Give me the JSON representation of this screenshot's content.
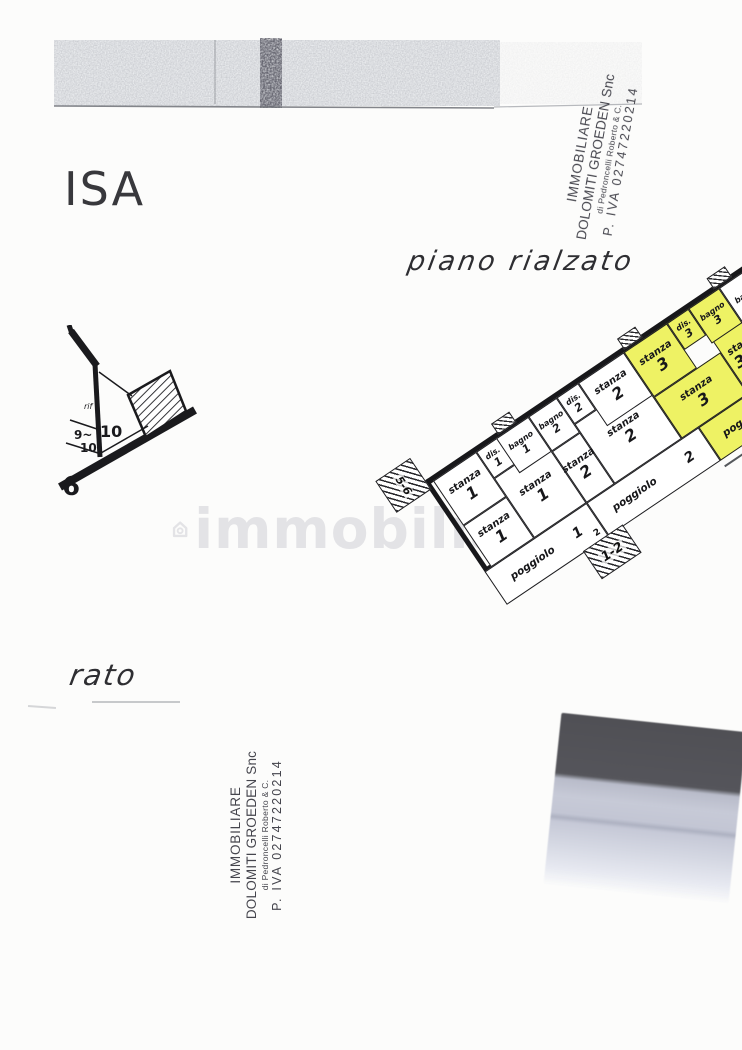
{
  "handwriting": {
    "isa": "ISA",
    "piano_rialzato": "piano rialzato",
    "rato": "rato"
  },
  "stamp": {
    "line1": "IMMOBILIARE",
    "line2": "DOLOMITI GROEDEN Snc",
    "line3": "di Pedroncelli Roberto & C.",
    "line4": "P. IVA 02747220214"
  },
  "watermark": {
    "icon": "house-icon",
    "text": "immobiliare"
  },
  "floor_plan": {
    "highlight_color": "#eef264",
    "room_labels": {
      "stanza": "stanza",
      "bagno": "bagno",
      "dis": "dis.",
      "poggiolo": "poggiolo"
    },
    "units": [
      {
        "number": "1"
      },
      {
        "number": "2"
      },
      {
        "number": "3"
      }
    ],
    "stairs": {
      "left": "5-6",
      "mid": "1-2",
      "mid_upper": "2"
    }
  },
  "fragment_plan": {
    "rif": "rif",
    "room_a": "10",
    "room_b": "9~",
    "room_b2": "10",
    "corner": "6"
  }
}
